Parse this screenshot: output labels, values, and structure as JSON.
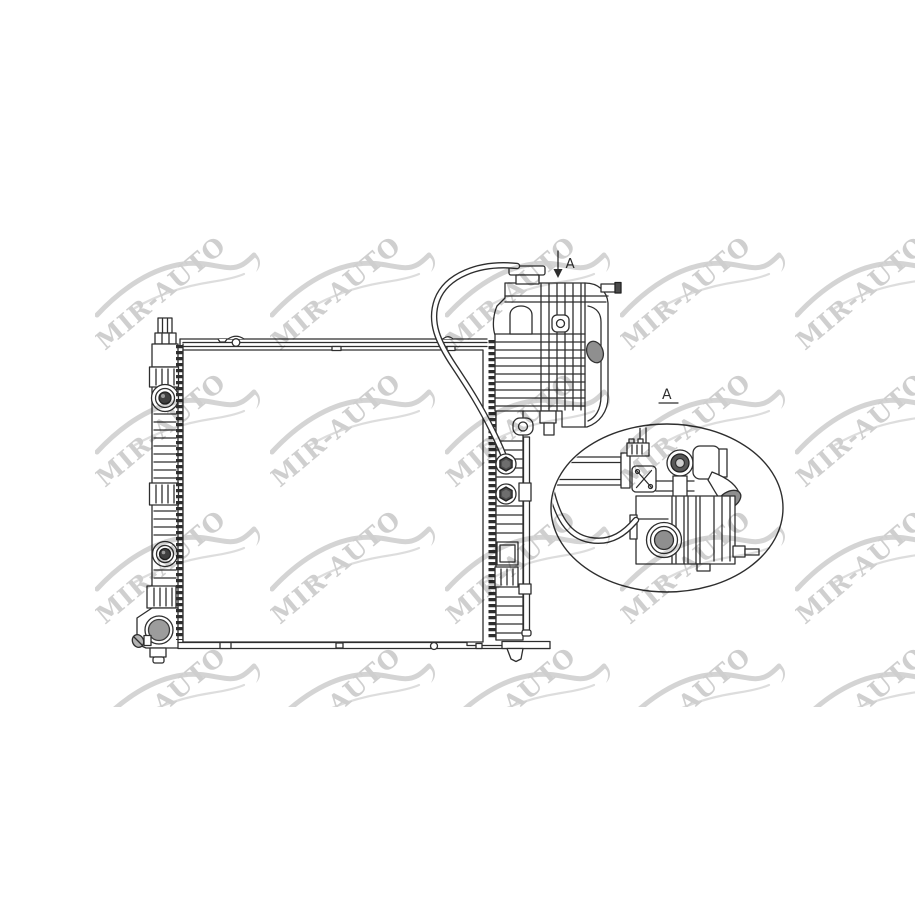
{
  "canvas": {
    "width": 915,
    "height": 915,
    "background": "#ffffff"
  },
  "watermark": {
    "text": "MIR-AUTO",
    "text_color": "#c7c7c7",
    "swoosh_color": "#cdcdcd",
    "columns": 5,
    "rows": 4
  },
  "drawing": {
    "type": "technical-line-drawing",
    "subject": "Radiator assembly with side tank and expansion tank, catalog illustration",
    "line_color": "#2e2e2e",
    "fill_gray": "#8f8f8f",
    "fill_dark": "#4f4f4f",
    "arrow_marker": {
      "label": "A"
    },
    "detail_callout": {
      "label": "A"
    }
  }
}
